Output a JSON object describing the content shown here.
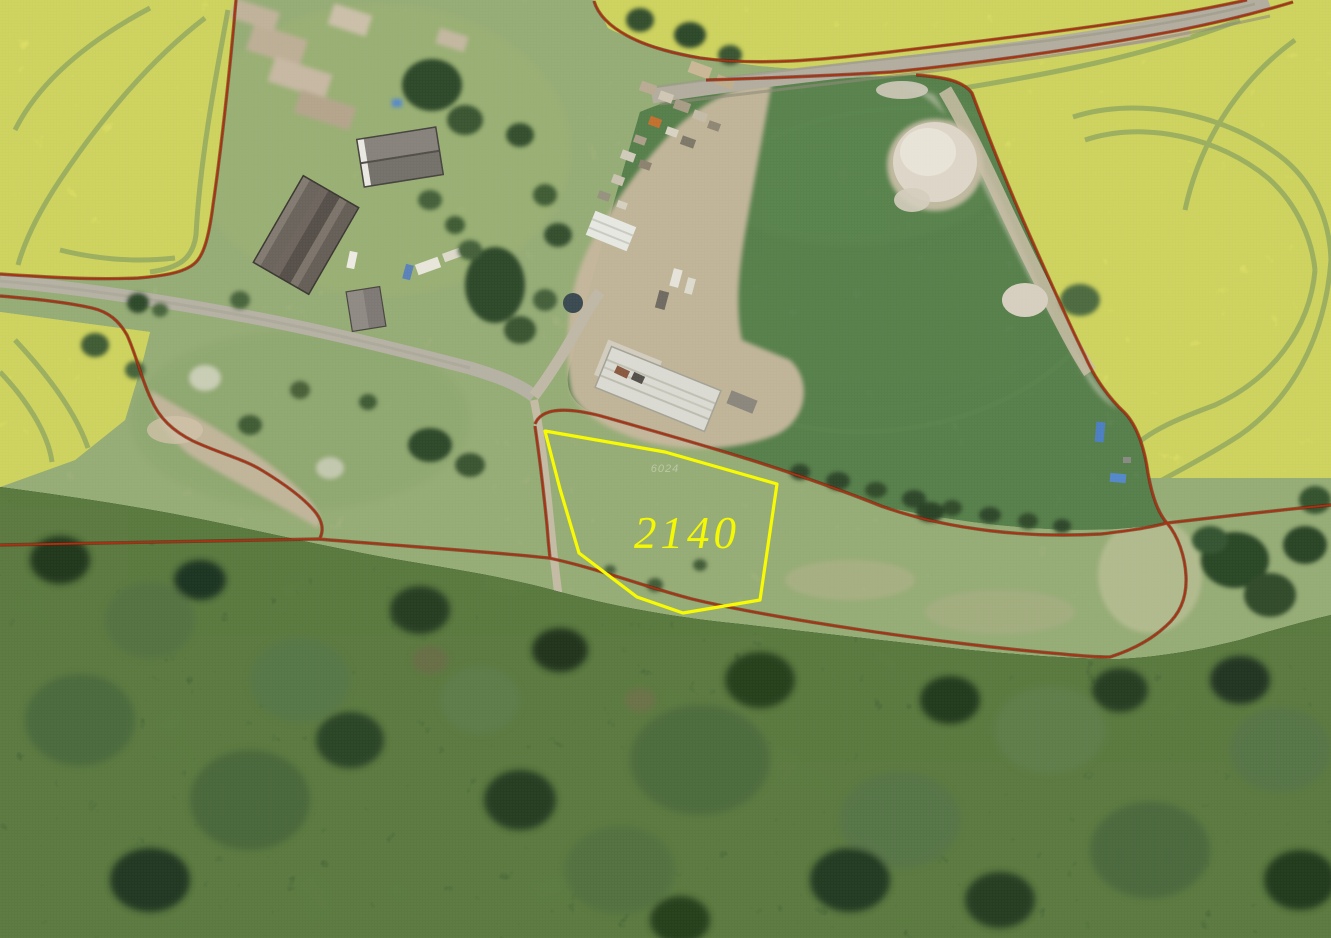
{
  "map": {
    "kind": "cadastral-aerial-map",
    "parcel": {
      "number": "2140",
      "outline_color": "#f8fb00",
      "label_color": "#f5f900"
    },
    "faint_parcel_label": "6024",
    "colors": {
      "cadastral_line": "#a93012",
      "cadastral_line_shadow": "#5f1a06",
      "rapeseed_field": "#d6d84e",
      "pasture": "#4f7846",
      "meadow": "#93a973",
      "forest": "#3a5531",
      "road": "#b5b1a3",
      "dirt": "#c6b79d",
      "sand_pile": "#ddd6c8",
      "roof_dark": "#5a544e",
      "roof_light": "#dbdad2",
      "tarp_blue": "#5588c8"
    }
  }
}
